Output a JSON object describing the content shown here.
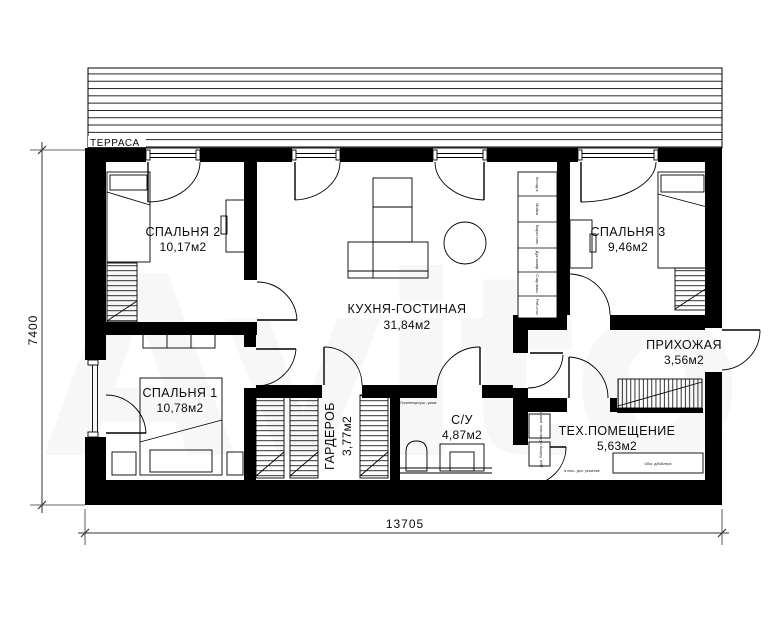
{
  "watermark": {
    "text": "Avito"
  },
  "terrace": {
    "label": "ТЕРРАСА"
  },
  "dimensions": {
    "bottom": "13705",
    "left": "7400"
  },
  "rooms": [
    {
      "name": "СПАЛЬНЯ 2",
      "area": "10,17м2"
    },
    {
      "name": "КУХНЯ-ГОСТИНАЯ",
      "area": "31,84м2"
    },
    {
      "name": "СПАЛЬНЯ 3",
      "area": "9,46м2"
    },
    {
      "name": "ПРИХОЖАЯ",
      "area": "3,56м2"
    },
    {
      "name": "СПАЛЬНЯ 1",
      "area": "10,78м2"
    },
    {
      "name": "ГАРДЕРОБ",
      "area": "3,77м2"
    },
    {
      "name": "С/У",
      "area": "4,87м2"
    },
    {
      "name": "ТЕХ.ПОМЕЩЕНИЕ",
      "area": "5,63м2"
    }
  ],
  "kitchen_counter": {
    "cells": [
      "Холод-к",
      "Мойка",
      "Вароч.пан.",
      "Дух.шкаф",
      "Стир.маш.",
      "Раб.стол"
    ]
  },
  "annotations": {
    "bathroom_note": "Полотенцесуш.; умыв.",
    "tech_left_1": "Стир.маш. разм.40",
    "tech_left_2": "Душ. бойлер г/х",
    "tech_bottom": "Обог. д/бойлера",
    "tech_door": "в пом.- доп. решение"
  },
  "colors": {
    "wall": "#000000",
    "background": "#ffffff",
    "line": "#1c1c1c"
  }
}
